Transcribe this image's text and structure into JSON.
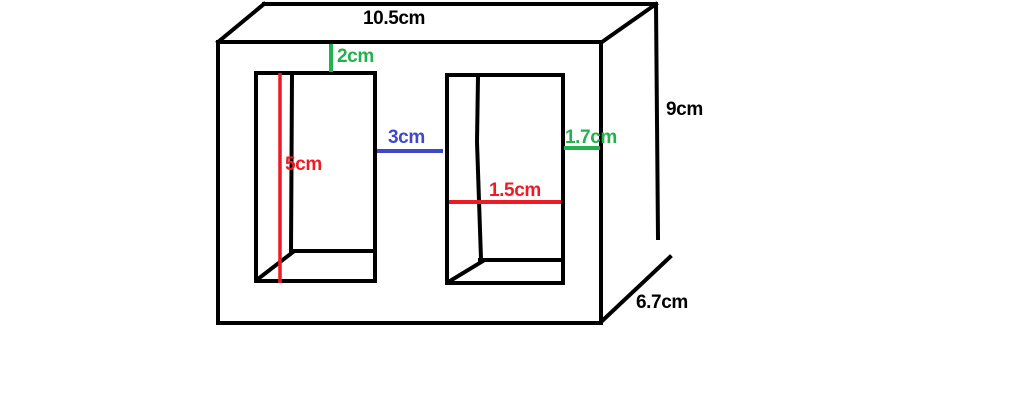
{
  "colors": {
    "line": "#000000",
    "red": "#ED1C24",
    "green": "#22B14C",
    "blue": "#3F48CC",
    "background": "#FFFFFF"
  },
  "diagram": {
    "dimensions": {
      "top_width": "10.5cm",
      "top_margin": "2cm",
      "box_height": "9cm",
      "box_depth": "6.7cm",
      "gap_between_holes": "3cm",
      "right_margin": "1.7cm",
      "left_hole_height": "5cm",
      "right_hole_width": "1.5cm"
    }
  }
}
